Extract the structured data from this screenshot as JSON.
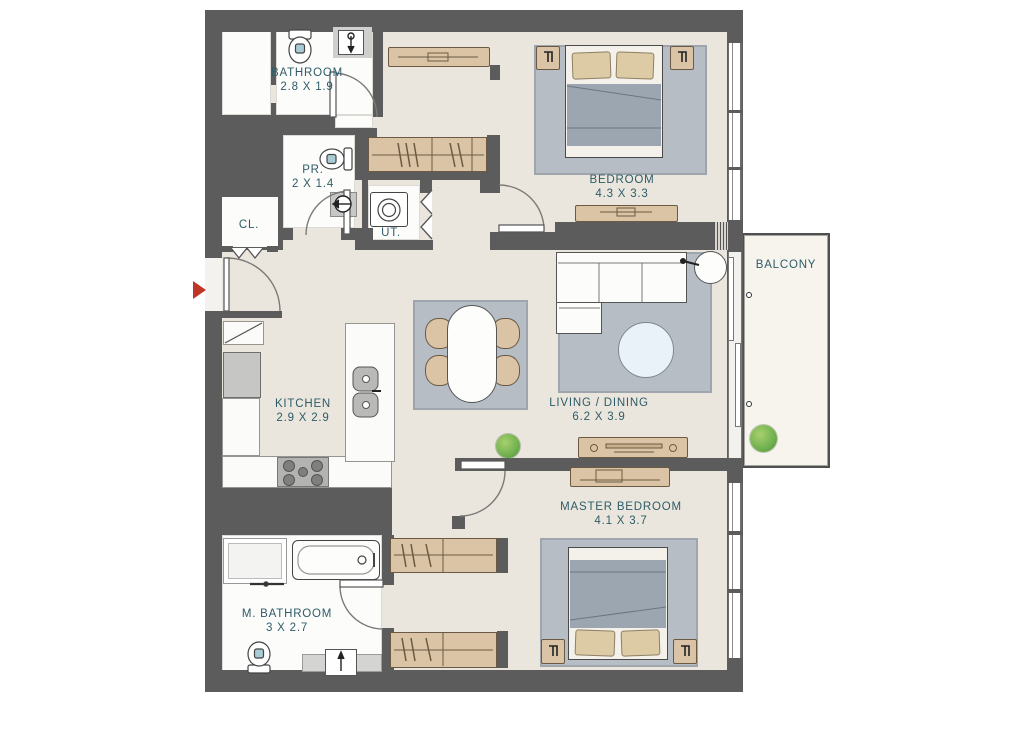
{
  "title": "Apartment Floor Plan",
  "colors": {
    "wall": "#5c5c5c",
    "floor": "#eae6dd",
    "label": "#2e5c68",
    "accent": "#c13528",
    "wood": "#dbc4a5",
    "rug": "#b7bdc4",
    "bed": "#9ca6b0",
    "pillow": "#ddcba6",
    "plant": "#6faf4e",
    "balcony_floor": "#f7f4ed"
  },
  "rooms": {
    "bathroom": {
      "name": "BATHROOM",
      "dims": "2.8 X 1.9"
    },
    "powder_room": {
      "name": "PR.",
      "dims": "2 X 1.4"
    },
    "closet": {
      "name": "CL."
    },
    "utility": {
      "name": "UT."
    },
    "bedroom": {
      "name": "BEDROOM",
      "dims": "4.3 X 3.3"
    },
    "balcony": {
      "name": "BALCONY"
    },
    "kitchen": {
      "name": "KITCHEN",
      "dims": "2.9 X 2.9"
    },
    "living_dining": {
      "name": "LIVING / DINING",
      "dims": "6.2 X 3.9"
    },
    "master_bedroom": {
      "name": "MASTER BEDROOM",
      "dims": "4.1 X 3.7"
    },
    "master_bathroom": {
      "name": "M. BATHROOM",
      "dims": "3 X 2.7"
    }
  }
}
